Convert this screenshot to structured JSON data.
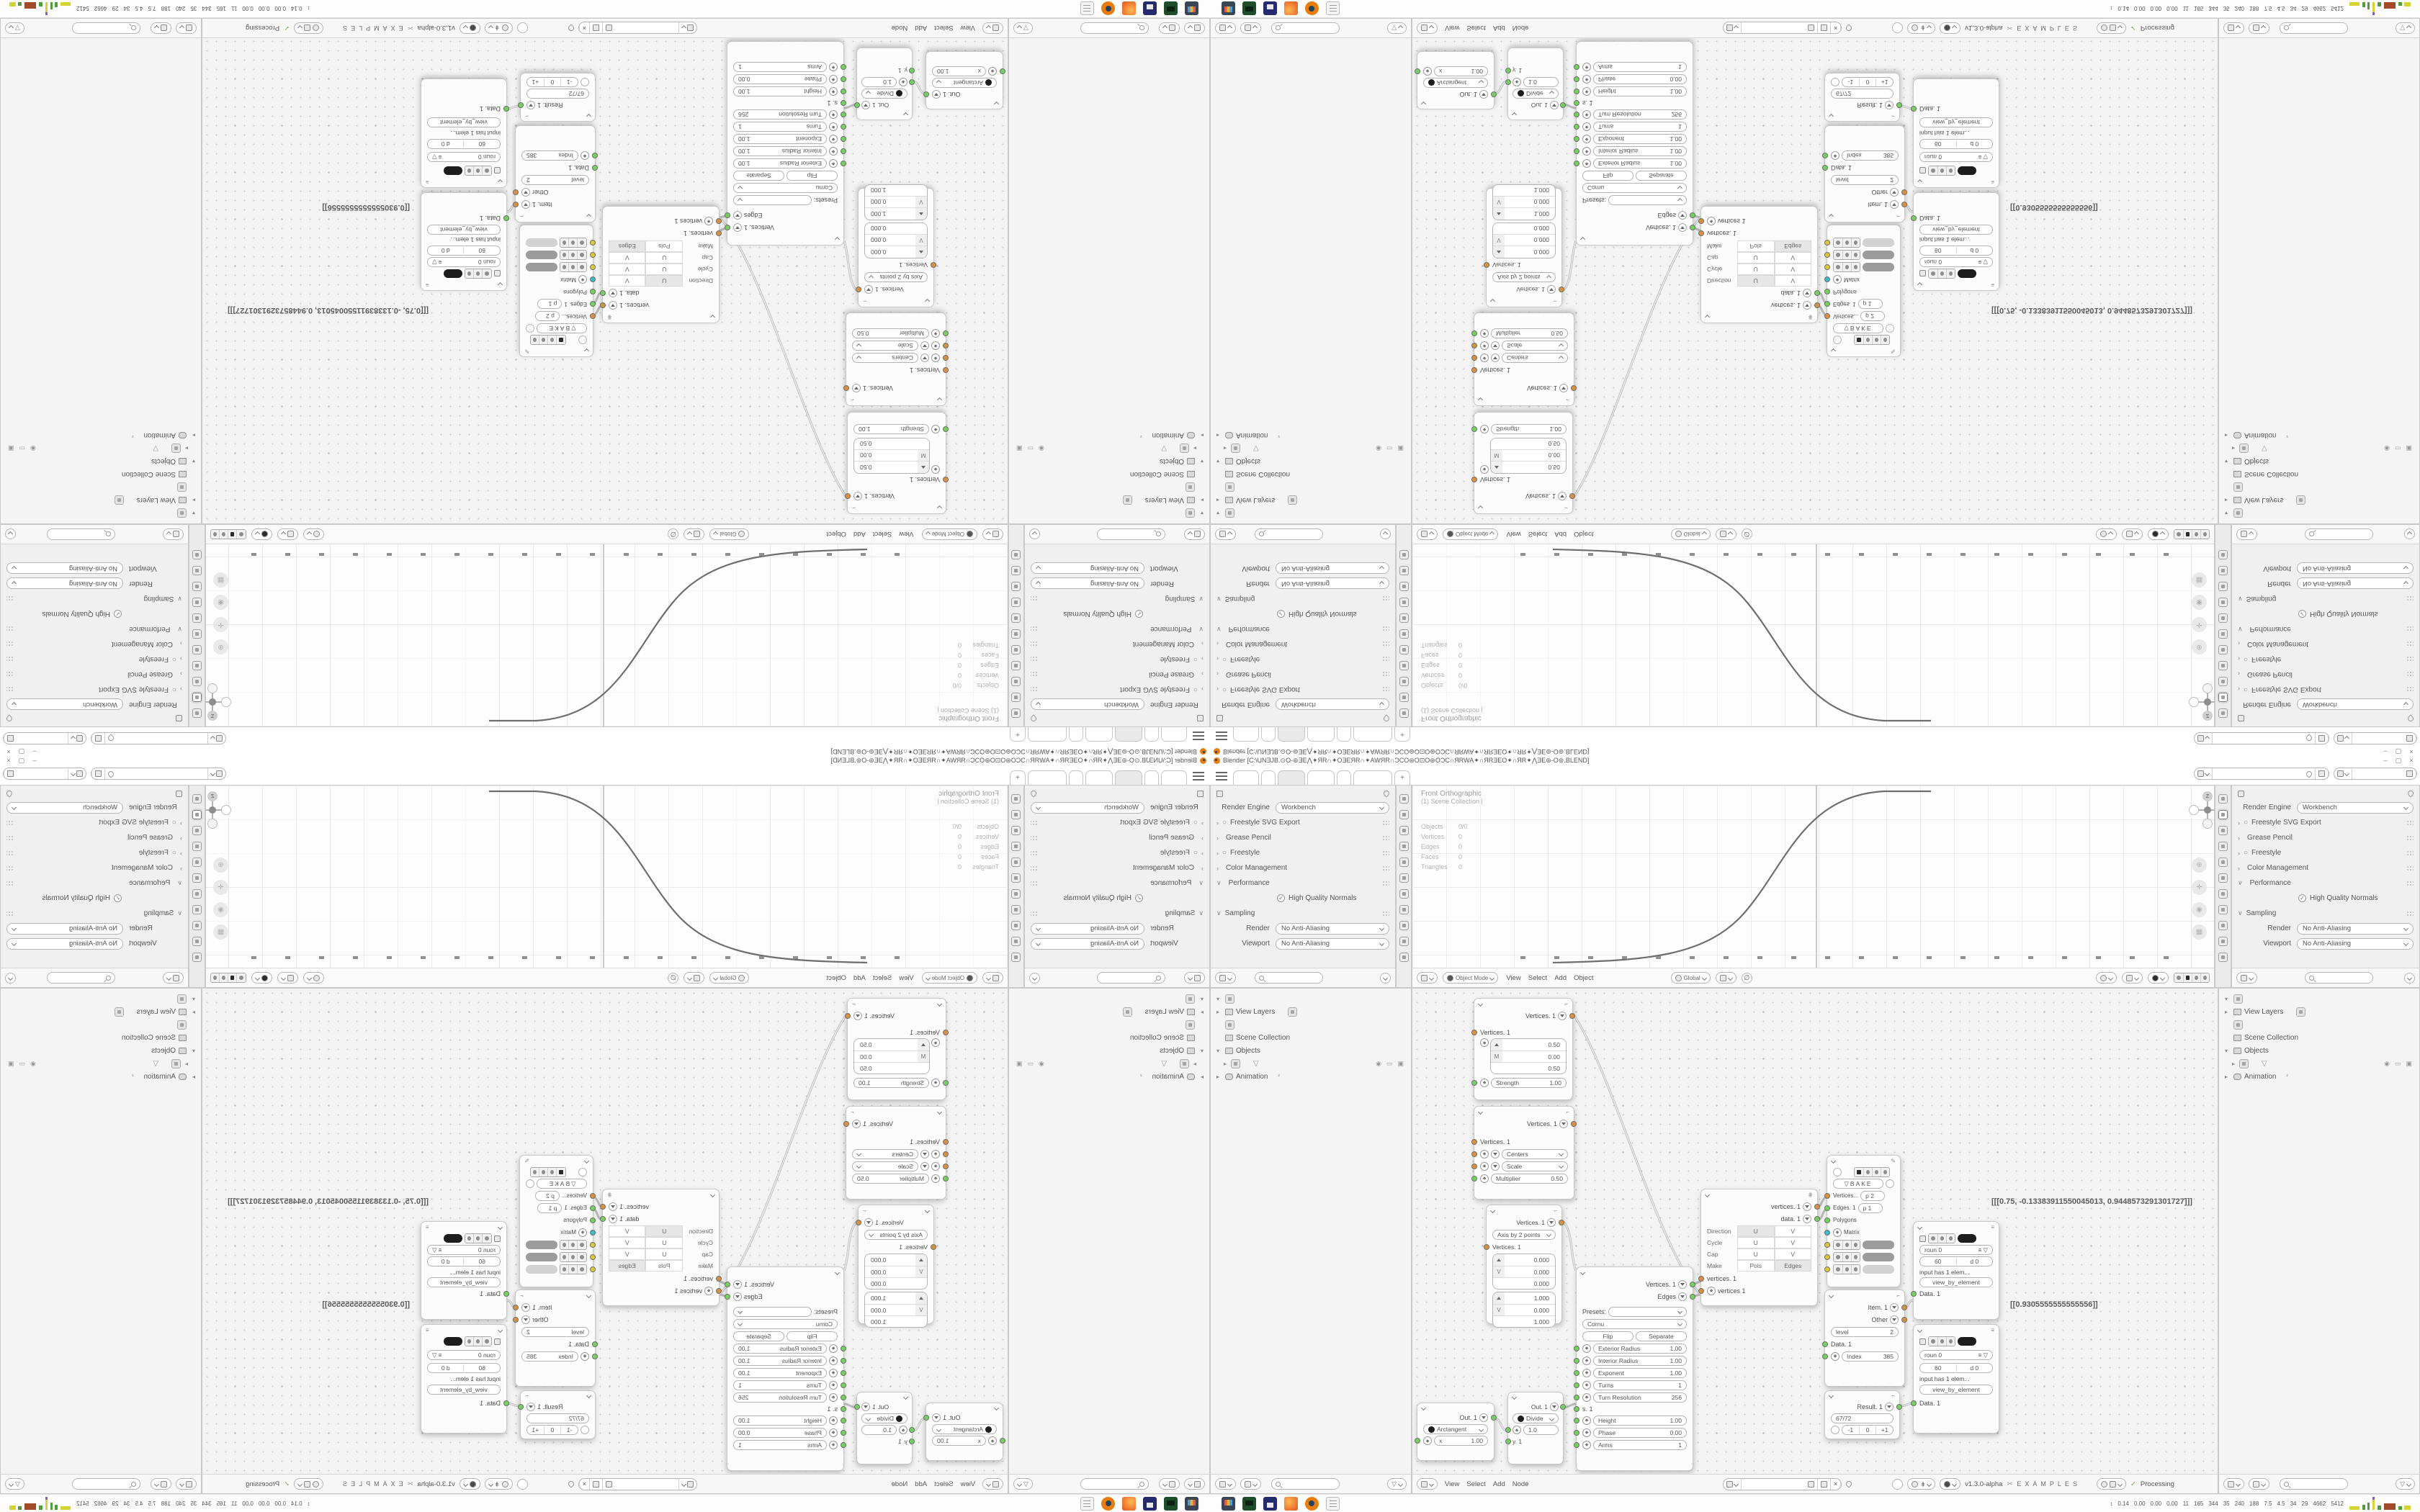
{
  "titlebar": {
    "app_title": "Blender [C:\\UNƎJB.⊙O-⊚ƎE⋀✦ЯR∩✦OƎEЯR∩✦AWЯR∩ƆCO⊛O⊡O⊛OƆC∩ЯRWA✦∩ЯRƎEO✦∩ЯR✦⋀ƎE⊚-O⊚.BLEND]",
    "minimize": "–",
    "maximize": "▢",
    "close": "×"
  },
  "workspace": {
    "new_tab": "+"
  },
  "properties": {
    "render_engine_label": "Render Engine",
    "render_engine_value": "Workbench",
    "sections": [
      {
        "chev": "›",
        "radio": "○",
        "label": "Freestyle SVG Export"
      },
      {
        "chev": "›",
        "radio": "",
        "label": "Grease Pencil"
      },
      {
        "chev": "›",
        "radio": "○",
        "label": "Freestyle"
      },
      {
        "chev": "›",
        "radio": "",
        "label": "Color Management"
      },
      {
        "chev": "∨",
        "radio": "",
        "label": "Performance"
      }
    ],
    "high_quality_normals": "High Quality Normals",
    "check_mark": "✓",
    "sampling_chev": "∨",
    "sampling_label": "Sampling",
    "render_label": "Render",
    "render_value": "No Anti-Aliasing",
    "viewport_label": "Viewport",
    "viewport_value": "No Anti-Aliasing"
  },
  "viewport": {
    "overlay_title": "Front Orthographic",
    "overlay_subtitle": "(1) Scene Collection |",
    "stats": [
      {
        "k": "Objects",
        "v": "0/0"
      },
      {
        "k": "Vertices",
        "v": "0"
      },
      {
        "k": "Edges",
        "v": "0"
      },
      {
        "k": "Faces",
        "v": "0"
      },
      {
        "k": "Triangles",
        "v": "0"
      }
    ],
    "mode": "Object Mode",
    "menus": [
      "View",
      "Select",
      "Add",
      "Object"
    ],
    "orientation": "Global",
    "axis_z": "Z",
    "axis_x": "X"
  },
  "outliner": {
    "view_layers": "View Layers",
    "scene_collection": "Scene Collection",
    "objects": "Objects",
    "animation": "Animation",
    "animation_badge": "²"
  },
  "node_editor": {
    "menus": [
      "View",
      "Select",
      "Add",
      "Node"
    ],
    "version": "v1.3.0-alpha",
    "examples": "EXAMPLES",
    "processing": "Processing",
    "values": {
      "v1": "[[[0.75, -0.13383911550045013, 0.9448573291301727]]]",
      "v2": "[[0.9305555555555556]]"
    },
    "n1": {
      "out": "Vertices. 1",
      "in": "Vertices. 1",
      "v0": "0.50",
      "v1": "0.00",
      "v2": "0.50",
      "m": "M",
      "strength_label": "Strength",
      "strength_value": "1.00"
    },
    "n2": {
      "out": "Vertices. 1",
      "in": "Vertices. 1",
      "opt1": "Centers",
      "opt2": "Scale",
      "mult_label": "Multiplier",
      "mult_value": "0.50"
    },
    "n3": {
      "out": "Vertices. 1",
      "mode": "Axis by 2 points",
      "in": "Vertices. 1",
      "mark": "V",
      "a0": "0.000",
      "a1": "0.000",
      "a2": "0.000",
      "b0": "1.000",
      "b1": "0.000",
      "b2": "1.000"
    },
    "n4": {
      "out1": "Vertices. 1",
      "out2": "Edges",
      "presets_label": "Presets:",
      "type": "Cornu",
      "flip": "Flip",
      "separate": "Separate",
      "params": [
        {
          "k": "Exterior Radius",
          "v": "1.00"
        },
        {
          "k": "Interior Radius",
          "v": "1.00"
        },
        {
          "k": "Exponent",
          "v": "1.00"
        },
        {
          "k": "Turns",
          "v": "1"
        },
        {
          "k": "Turn Resolution",
          "v": "256"
        }
      ],
      "s_label": "s. 1",
      "params2": [
        {
          "k": "Height",
          "v": "1.00"
        },
        {
          "k": "Phase",
          "v": "0.00"
        },
        {
          "k": "Arms",
          "v": "1"
        }
      ]
    },
    "n5": {
      "out1": "vertices. 1",
      "out2": "data. 1",
      "in1": "vertices. 1",
      "in2": "vertices 1",
      "rows": [
        {
          "k": "Direction",
          "a": "U",
          "b": "V",
          "hla": "hl",
          "hlb": ""
        },
        {
          "k": "Cycle",
          "a": "U",
          "b": "V",
          "hla": "",
          "hlb": ""
        },
        {
          "k": "Cap",
          "a": "U",
          "b": "V",
          "hla": "",
          "hlb": ""
        },
        {
          "k": "Make",
          "a": "Pols",
          "b": "Edges",
          "hla": "",
          "hlb": "hl"
        }
      ]
    },
    "bake": {
      "label": "BAKE",
      "in1": "Vertices...",
      "in1v": "p  2",
      "in2": "Edges. 1",
      "in2v": "p  1",
      "in3": "Polygons",
      "in4": "Matrix"
    },
    "n7": {
      "out1": "Item. 1",
      "out2": "Other",
      "level_label": "level",
      "level_value": "2",
      "in1": "Data. 1",
      "index_label": "Index",
      "index_value": "385"
    },
    "n8": {
      "out": "Result. 1",
      "fraction": "67/72",
      "dec": "-1",
      "zero": "0",
      "inc": "+1"
    },
    "viewer": {
      "field1": "roun  0",
      "field2a": "60",
      "field2b": "d  0",
      "note": "input has 1 elem...",
      "mode": "view_by_element",
      "in": "Data. 1"
    },
    "arctangent": {
      "out": "Out. 1",
      "type": "Arctangent",
      "x_label": "x",
      "x_value": "1.00"
    },
    "divide": {
      "out": "Out. 1",
      "type": "Divide",
      "value": "1.0",
      "in2": "y. 1"
    }
  },
  "taskbar": {
    "stats": [
      "0.14",
      "0.00",
      "0.00",
      "0.00",
      "11",
      "165",
      "344",
      "35",
      "240",
      "188",
      "7.5",
      "4.5",
      "34",
      "29",
      "4662",
      "5412"
    ],
    "graph_colors": [
      "#d6d433",
      "#4f9e3a",
      "#8a5bbf",
      "#a24a28"
    ]
  },
  "socket_colors": {
    "geometry": "#d9913d",
    "value": "#74d15e",
    "matrix": "#3dbac6",
    "field": "#dcc93a"
  }
}
